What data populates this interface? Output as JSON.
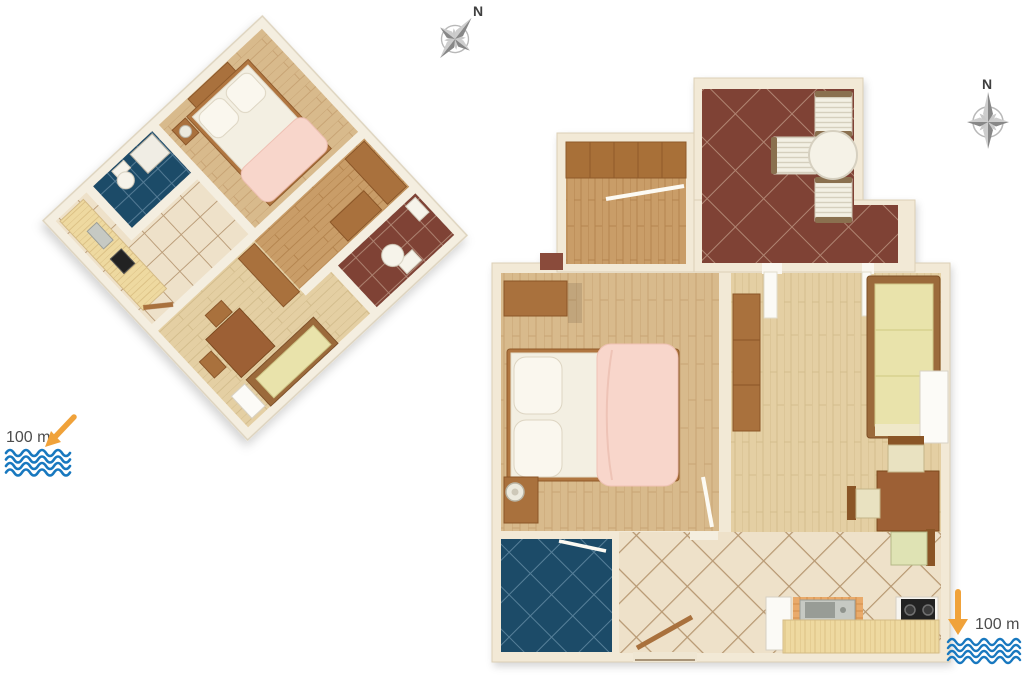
{
  "canvas": {
    "width": 1024,
    "height": 683,
    "background": "#ffffff"
  },
  "compasses": {
    "left": {
      "label": "N"
    },
    "right": {
      "label": "N"
    }
  },
  "sea_markers": {
    "bottom_left": {
      "label": "100 m"
    },
    "bottom_right": {
      "label": "100 m"
    }
  },
  "plans": {
    "left": {
      "view": "3d-rotated-floor-plan",
      "rooms": [
        "bedroom",
        "hallway-wardrobes",
        "wc-bathroom",
        "shower-room",
        "living-room",
        "dining-area",
        "kitchen"
      ]
    },
    "right": {
      "view": "2d-top-down-floor-plan",
      "rooms": [
        "terrace",
        "entry-hall-closet",
        "bedroom",
        "living-room",
        "bathroom",
        "kitchen",
        "hallway"
      ]
    }
  },
  "palette": {
    "wall_cream": "#f2e9d6",
    "wood_light": "#e4cfa3",
    "wood_mid": "#d8ba8c",
    "wood_dark": "#c99d68",
    "furniture_brown": "#a9713e",
    "table_brown": "#9d6134",
    "terrace_tile_red": "#7f4334",
    "bathroom_tile_navy": "#1e4c67",
    "floor_tile_beige": "#eee1c9",
    "couch_yellow": "#e9e3ab",
    "bed_blanket_pink": "#f8d6cb",
    "sea_wave_blue": "#1878bf",
    "arrow_orange": "#f0a23a",
    "compass_gray": "#8d8d8d",
    "label_gray": "#4d4d4d"
  }
}
